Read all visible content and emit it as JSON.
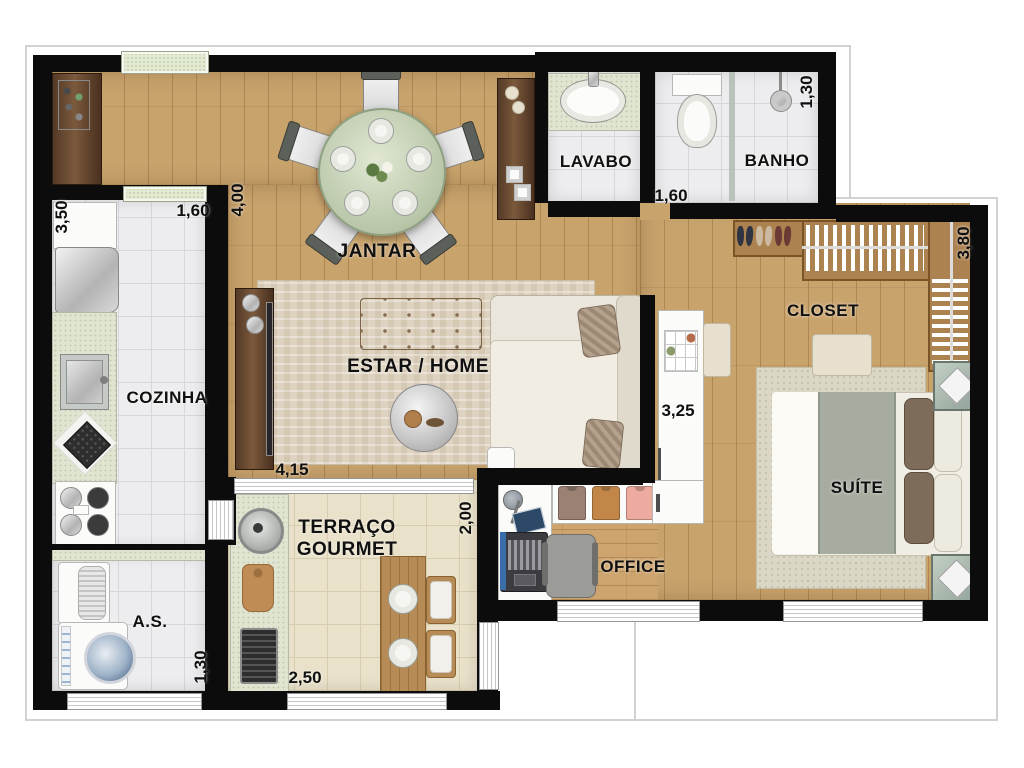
{
  "title": "Apartment floor plan with gourmet terrace",
  "rooms": {
    "jantar": "JANTAR",
    "estar": "ESTAR / HOME",
    "cozinha": "COZINHA",
    "area_servico": "A.S.",
    "lavabo": "LAVABO",
    "banho": "BANHO",
    "closet": "CLOSET",
    "suite": "SUÍTE",
    "office": "OFFICE",
    "terraco_line1": "TERRAÇO",
    "terraco_line2": "GOURMET"
  },
  "dimensions_m": {
    "cozinha_height": "3,50",
    "cozinha_width": "1,60",
    "jantar_height": "4,00",
    "banho_height": "1,30",
    "banho_width": "1,60",
    "closet_height": "3,80",
    "suite_height": "3,25",
    "estar_width": "4,15",
    "terraco_height": "2,00",
    "as_height": "1,30",
    "terraco_width": "2,50"
  },
  "colors": {
    "wall": "#0c0c0c",
    "wood_floor": "#c9a36c",
    "tile_white": "#ededef",
    "tile_cream": "#e9e1c9",
    "rug_estar": "#ded3c0",
    "rug_suite": "#dbd7c6",
    "granite": "#e0e5d2",
    "window_glass": "#e2ead4",
    "label_text": "#101010"
  }
}
